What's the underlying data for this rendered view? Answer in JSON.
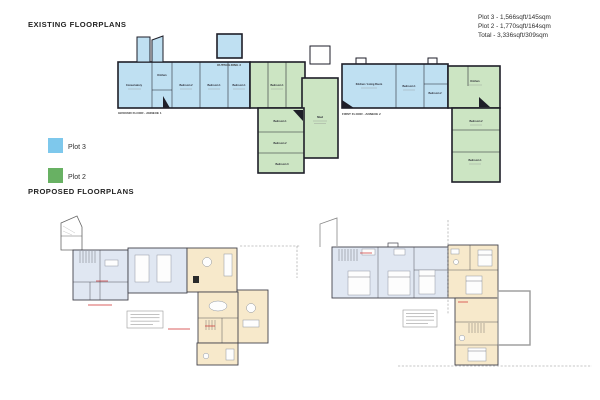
{
  "existing": {
    "title": "EXISTING FLOORPLANS",
    "stats": {
      "plot3": "Plot 3 - 1,566sqft/145sqm",
      "plot2": "Plot 2 - 1,770sqft/164sqm",
      "total": "Total - 3,336sqft/309sqm"
    },
    "legend": {
      "plot3_label": "Plot 3",
      "plot3_color": "#7ec8ec",
      "plot2_label": "Plot 2",
      "plot2_color": "#68b163"
    },
    "captions": {
      "outbuilding": "OUTBUILDING 3",
      "ground_floor": "GROUND FLOOR - ANNEXE 1",
      "first_floor": "FIRST FLOOR - ANNEXE 2"
    },
    "rooms": {
      "conservatory": "Conservatory",
      "kitchen_annexe1": "Kitchen",
      "bedroom2_annexe1": "Bedroom 2",
      "bedroom1_annexe1": "Bedroom 1",
      "bedroom1b_annexe1": "Bedroom 1",
      "bedroom1_green": "Bedroom 1",
      "shed": "Shed",
      "bedroom1_wing": "Bedroom 1",
      "bedroom2_wing": "Bedroom 2",
      "bedroom3_wing": "Bedroom 3",
      "kitchen_living": "Kitchen / Living Room",
      "bedroom1_annexe2": "Bedroom 1",
      "bedroom2_annexe2": "Bedroom 2",
      "kitchen_right": "Kitchen",
      "bedroom2_right": "Bedroom 2",
      "bedroom1_right": "Bedroom 1"
    },
    "colors": {
      "plot3_fill": "#bfe0f2",
      "plot2_fill": "#cce5c3",
      "wall": "#1e1e28"
    }
  },
  "proposed": {
    "title": "PROPOSED FLOORPLANS",
    "colors": {
      "room_blue": "#e0e7f2",
      "room_cream": "#f7e9cb",
      "wall": "#43434c",
      "terrace_outline": "#9a9a9a",
      "annotation_red": "#cf2b2b"
    }
  }
}
